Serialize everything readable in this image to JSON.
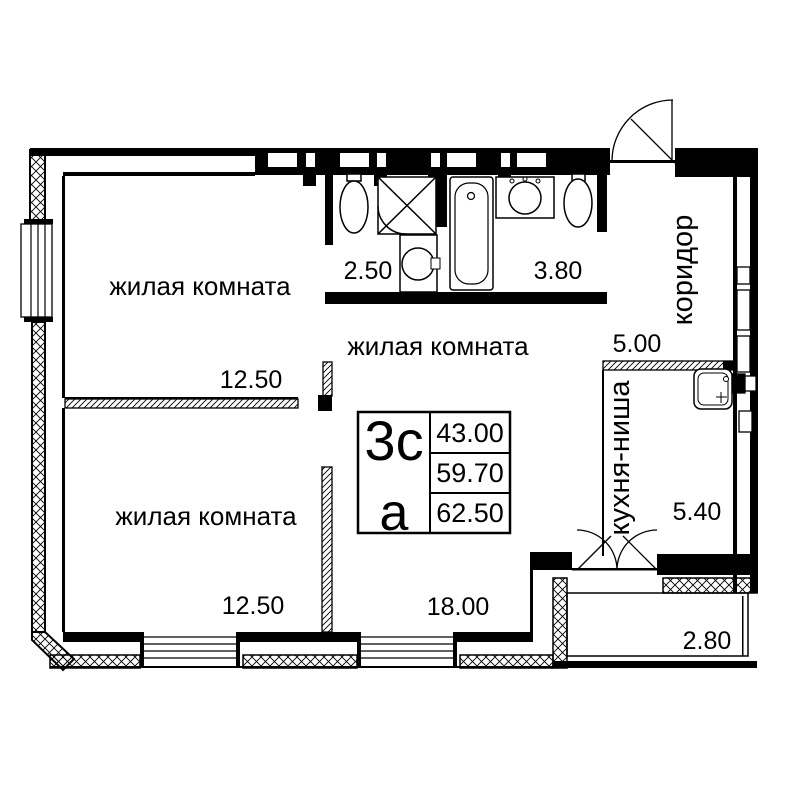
{
  "plan": {
    "rooms": {
      "living_top": {
        "label": "жилая комната",
        "area": "12.50"
      },
      "living_center": {
        "label": "жилая комната",
        "area": "18.00"
      },
      "living_bottom": {
        "label": "жилая комната",
        "area": "12.50"
      },
      "bath_small": {
        "area": "2.50"
      },
      "bath_large": {
        "area": "3.80"
      },
      "corridor": {
        "label": "коридор",
        "area": "5.00"
      },
      "kitchen": {
        "label": "кухня-ниша",
        "area": "5.40"
      },
      "balcony": {
        "area": "2.80"
      }
    },
    "stamp": {
      "type": "3с",
      "variant": "а",
      "values": [
        "43.00",
        "59.70",
        "62.50"
      ]
    },
    "colors": {
      "line": "#000000",
      "background": "#ffffff"
    }
  }
}
